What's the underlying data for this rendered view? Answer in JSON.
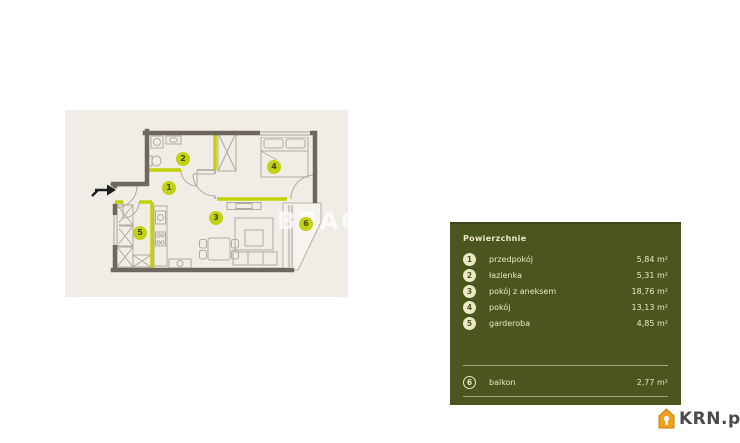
{
  "floorplan": {
    "watermark": "BRACIA",
    "badges": [
      {
        "num": "1"
      },
      {
        "num": "2"
      },
      {
        "num": "3"
      },
      {
        "num": "4"
      },
      {
        "num": "5"
      },
      {
        "num": "6"
      }
    ],
    "colors": {
      "canvas_bg": "#f0ede7",
      "wall": "#6e675f",
      "accent_wall": "#c3d107",
      "badge_fill": "#c3d113"
    }
  },
  "legend": {
    "title": "Powierzchnie",
    "rows": [
      {
        "num": "1",
        "label": "przedpokój",
        "area": "5,84 m²"
      },
      {
        "num": "2",
        "label": "łazienka",
        "area": "5,31 m²"
      },
      {
        "num": "3",
        "label": "pokój z aneksem",
        "area": "18,76 m²"
      },
      {
        "num": "4",
        "label": "pokój",
        "area": "13,13 m²"
      },
      {
        "num": "5",
        "label": "garderoba",
        "area": "4,85 m²"
      }
    ],
    "balcony_row": {
      "num": "6",
      "label": "balkon",
      "area": "2,77 m²"
    },
    "colors": {
      "panel_bg": "#4a551f",
      "text": "#ebe8c5"
    }
  },
  "branding": {
    "logo_text": "KRN.pl",
    "logo_color": "#f0a11c"
  }
}
